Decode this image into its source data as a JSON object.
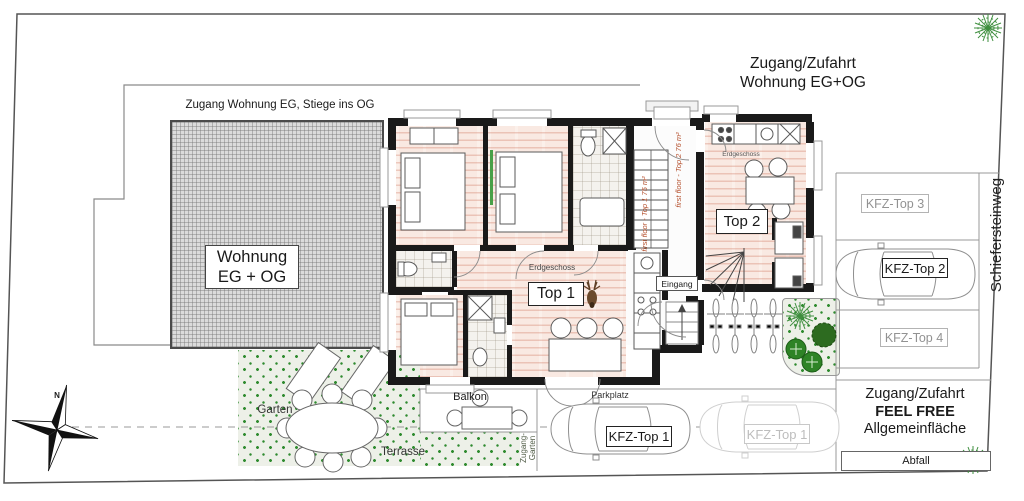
{
  "labels": {
    "access_top": {
      "line1": "Zugang/Zufahrt",
      "line2": "Wohnung EG+OG"
    },
    "access_eg": "Zugang Wohnung EG, Stiege ins OG",
    "wohnung_box": {
      "line1": "Wohnung",
      "line2": "EG + OG"
    },
    "street": "Schiefersteinweg",
    "top1": "Top 1",
    "top2": "Top 2",
    "erdgeschoss_top1": "Erdgeschoss",
    "erdgeschoss_top2": "Erdgeschoss",
    "eingang": "Eingang",
    "balkon": "Balkon",
    "garten": "Garten",
    "terrasse": "Terrasse",
    "zugang_garten": {
      "line1": "Zugang-",
      "line2": "Garten"
    },
    "parkplatz": "Parkplatz",
    "kfz_top1": "KFZ-Top 1",
    "kfz_top1_ghost": "KFZ-Top 1",
    "kfz_top2": "KFZ-Top 2",
    "kfz_top3": "KFZ-Top 3",
    "kfz_top4": "KFZ-Top 4",
    "allgemein": {
      "line1": "Zugang/Zufahrt",
      "line2": "FEEL FREE",
      "line3": "Allgemeinfläche"
    },
    "abfall": "Abfall",
    "compass_n": "N",
    "annotation_top1": "first floor - Top 1   75 m²",
    "annotation_top2": "first floor - Top 2   76 m²"
  },
  "colors": {
    "wall": "#1a1a1a",
    "floor_pink": "#f9e9e2",
    "floor_stroke": "#ca6a52",
    "hatch_grey": "#dbdbdb",
    "garden_green": "#2f8b2f",
    "annotation_red": "#b5502d",
    "label_grey": "#929292",
    "line_grey": "#8a8a8a"
  },
  "icons": [
    "compass-rose-icon",
    "deer-logo-icon",
    "car-icon",
    "bicycle-icon",
    "tree-icon",
    "bush-icon",
    "stairs-icon"
  ]
}
